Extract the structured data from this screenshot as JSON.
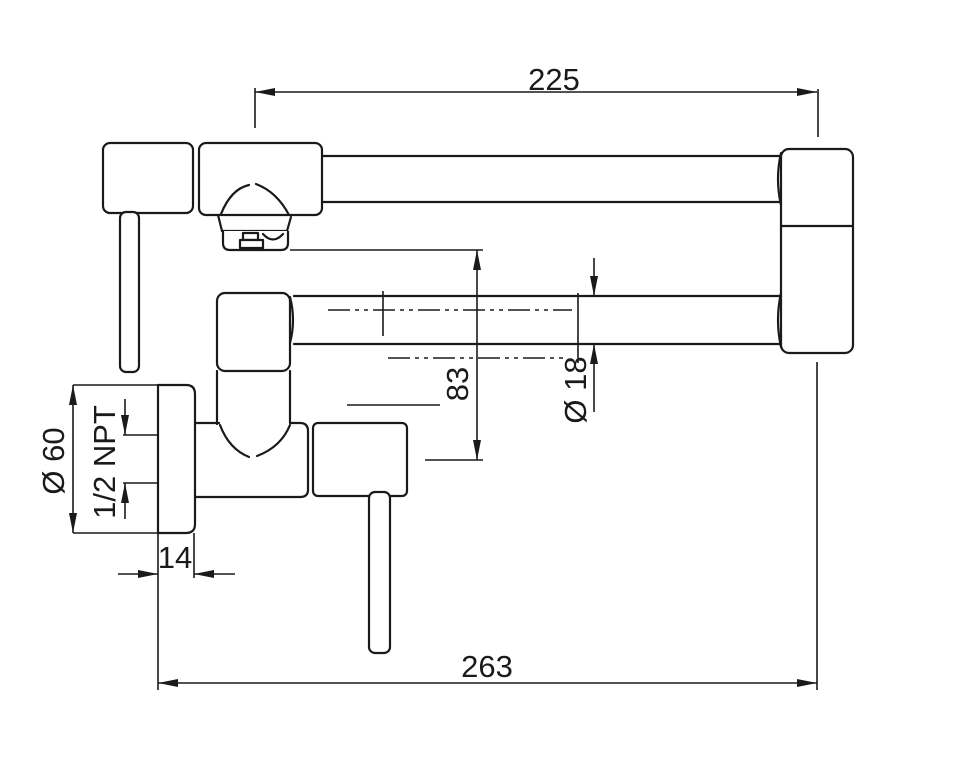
{
  "drawing": {
    "title": "pot-filler-faucet-dimension-drawing",
    "line_color": "#1a1a1a",
    "background_color": "#ffffff",
    "dimensions": {
      "spout_reach_top": "225",
      "overall_reach_bottom": "263",
      "nozzle_to_axis_height": "83",
      "pipe_diameter": "Ø 18",
      "flange_diameter": "Ø 60",
      "thread_spec": "1/2 NPT",
      "flange_depth": "14"
    }
  }
}
